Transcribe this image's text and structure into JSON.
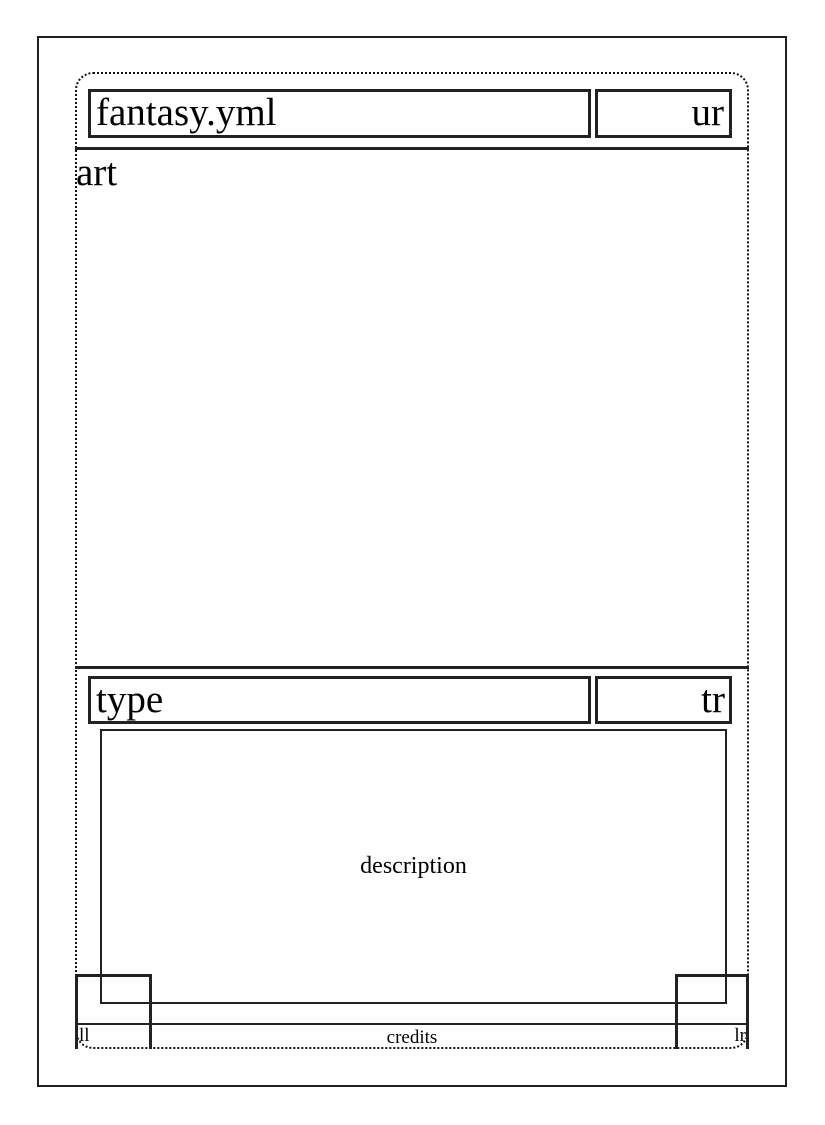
{
  "card": {
    "title": "fantasy.yml",
    "upper_right": "ur",
    "art_label": "art",
    "type_label": "type",
    "type_right": "tr",
    "description_label": "description",
    "lower_left": "ll",
    "lower_right": "lr",
    "credits_label": "credits"
  },
  "colors": {
    "background": "#ffffff",
    "line": "#222222",
    "outer_frame": "#1f1f1f",
    "text": "#000000"
  }
}
